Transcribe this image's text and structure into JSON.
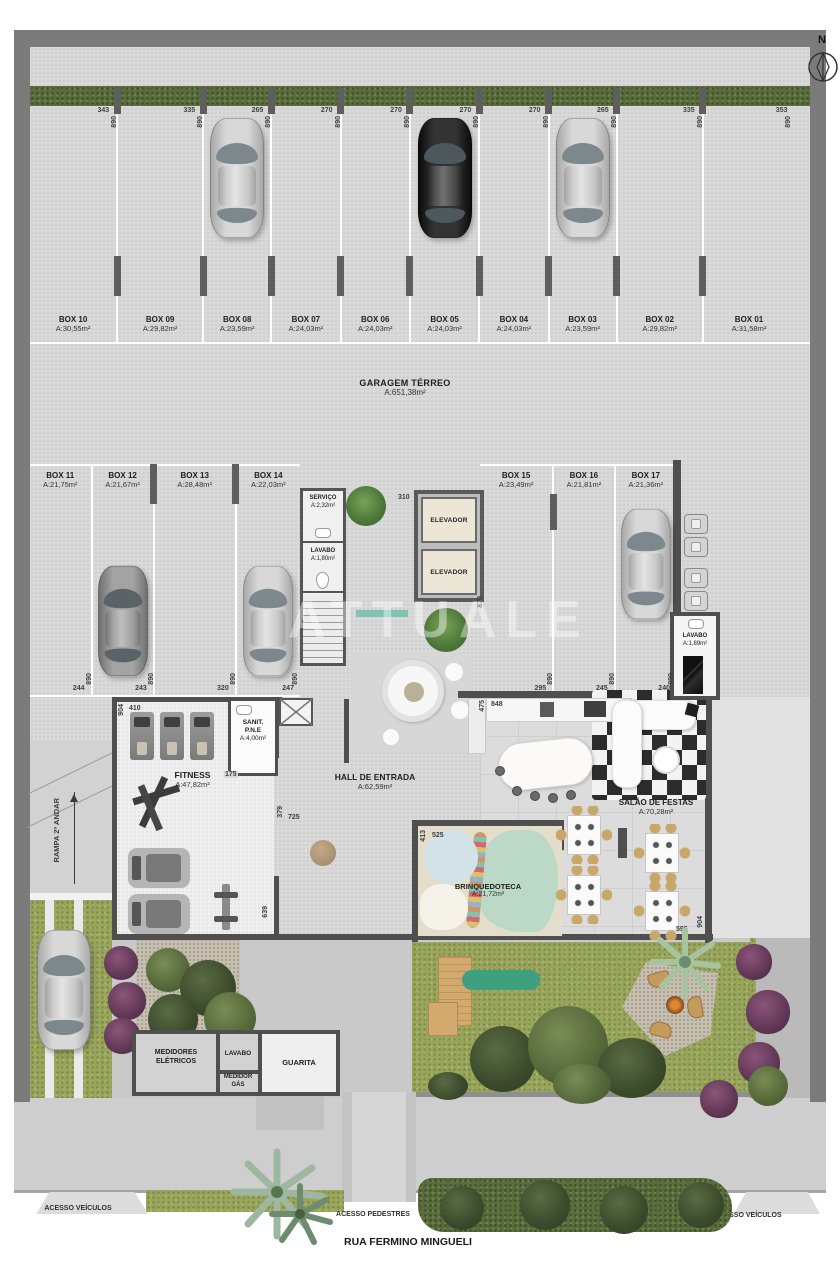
{
  "compass": {
    "label": "N"
  },
  "watermark": "ATTUALE",
  "garage": {
    "title": "GARAGEM TÉRREO",
    "area": "A:651,38m²",
    "depth_dim": "890",
    "top_boxes": [
      {
        "name": "BOX 10",
        "area": "A:30,55m²",
        "w": "343"
      },
      {
        "name": "BOX 09",
        "area": "A:29,82m²",
        "w": "335"
      },
      {
        "name": "BOX 08",
        "area": "A:23,59m²",
        "w": "265"
      },
      {
        "name": "BOX 07",
        "area": "A:24,03m²",
        "w": "270"
      },
      {
        "name": "BOX 06",
        "area": "A:24,03m²",
        "w": "270"
      },
      {
        "name": "BOX 05",
        "area": "A:24,03m²",
        "w": "270"
      },
      {
        "name": "BOX 04",
        "area": "A:24,03m²",
        "w": "270"
      },
      {
        "name": "BOX 03",
        "area": "A:23,59m²",
        "w": "265"
      },
      {
        "name": "BOX 02",
        "area": "A:29,82m²",
        "w": "335"
      },
      {
        "name": "BOX 01",
        "area": "A:31,58m²",
        "w": "353"
      }
    ],
    "mid_left_boxes": [
      {
        "name": "BOX 11",
        "area": "A:21,75m²",
        "w": "244"
      },
      {
        "name": "BOX 12",
        "area": "A:21,67m²",
        "w": "243"
      },
      {
        "name": "BOX 13",
        "area": "A:28,48m²",
        "w": "320"
      },
      {
        "name": "BOX 14",
        "area": "A:22,03m²",
        "w": "247"
      }
    ],
    "mid_right_boxes": [
      {
        "name": "BOX 15",
        "area": "A:23,49m²",
        "w": "295"
      },
      {
        "name": "BOX 16",
        "area": "A:21,81m²",
        "w": "245"
      },
      {
        "name": "BOX 17",
        "area": "A:21,36m²",
        "w": "240"
      }
    ]
  },
  "rooms": {
    "servico": {
      "name": "SERVIÇO",
      "area": "A:2,32m²"
    },
    "lavabo_terreo": {
      "name": "LAVABO",
      "area": "A:1,80m²"
    },
    "elevador": "ELEVADOR",
    "lavabo_social": {
      "name": "LAVABO",
      "area": "A:1,89m²"
    },
    "sanit": {
      "line1": "SANIT.",
      "line2": "P.N.E",
      "area": "A:4,00m²"
    },
    "fitness": {
      "name": "FITNESS",
      "area": "A:47,82m²"
    },
    "hall": {
      "name": "HALL DE ENTRADA",
      "area": "A:62,59m²"
    },
    "salao": {
      "name": "SALÃO DE FESTAS",
      "area": "A:70,28m²"
    },
    "brinquedoteca": {
      "name": "BRINQUEDOTECA",
      "area": "A:21,72m²"
    },
    "medidores": {
      "line1": "MEDIDORES",
      "line2": "ELÉTRICOS"
    },
    "lavabo_guarita": "LAVABO",
    "medidor_gas": {
      "line1": "MEDIDOR",
      "line2": "GÁS"
    },
    "guarita": "GUARITA"
  },
  "ramp": {
    "label": "RAMPA 2º ANDAR"
  },
  "dims": {
    "d310": "310",
    "d879": "879",
    "d904_fitness": "904",
    "d410": "410",
    "d175": "175",
    "d379": "379",
    "d725": "725",
    "d639": "639",
    "d413": "413",
    "d525": "525",
    "d595": "595",
    "d904_salao": "904",
    "d475": "475",
    "d848": "848"
  },
  "street": {
    "access_left": "ACESSO VEÍCULOS",
    "access_center": "ACESSO PEDESTRES",
    "access_right": "ACESSO VEÍCULOS",
    "road": "RUA FERMINO MINGUELI"
  },
  "colors": {
    "wall": "#7b7b7b",
    "inner_wall": "#4f4f4f",
    "grass": "#99a55b",
    "hedge": "#5a6c3c",
    "teal_accent": "#7fc3b4"
  }
}
